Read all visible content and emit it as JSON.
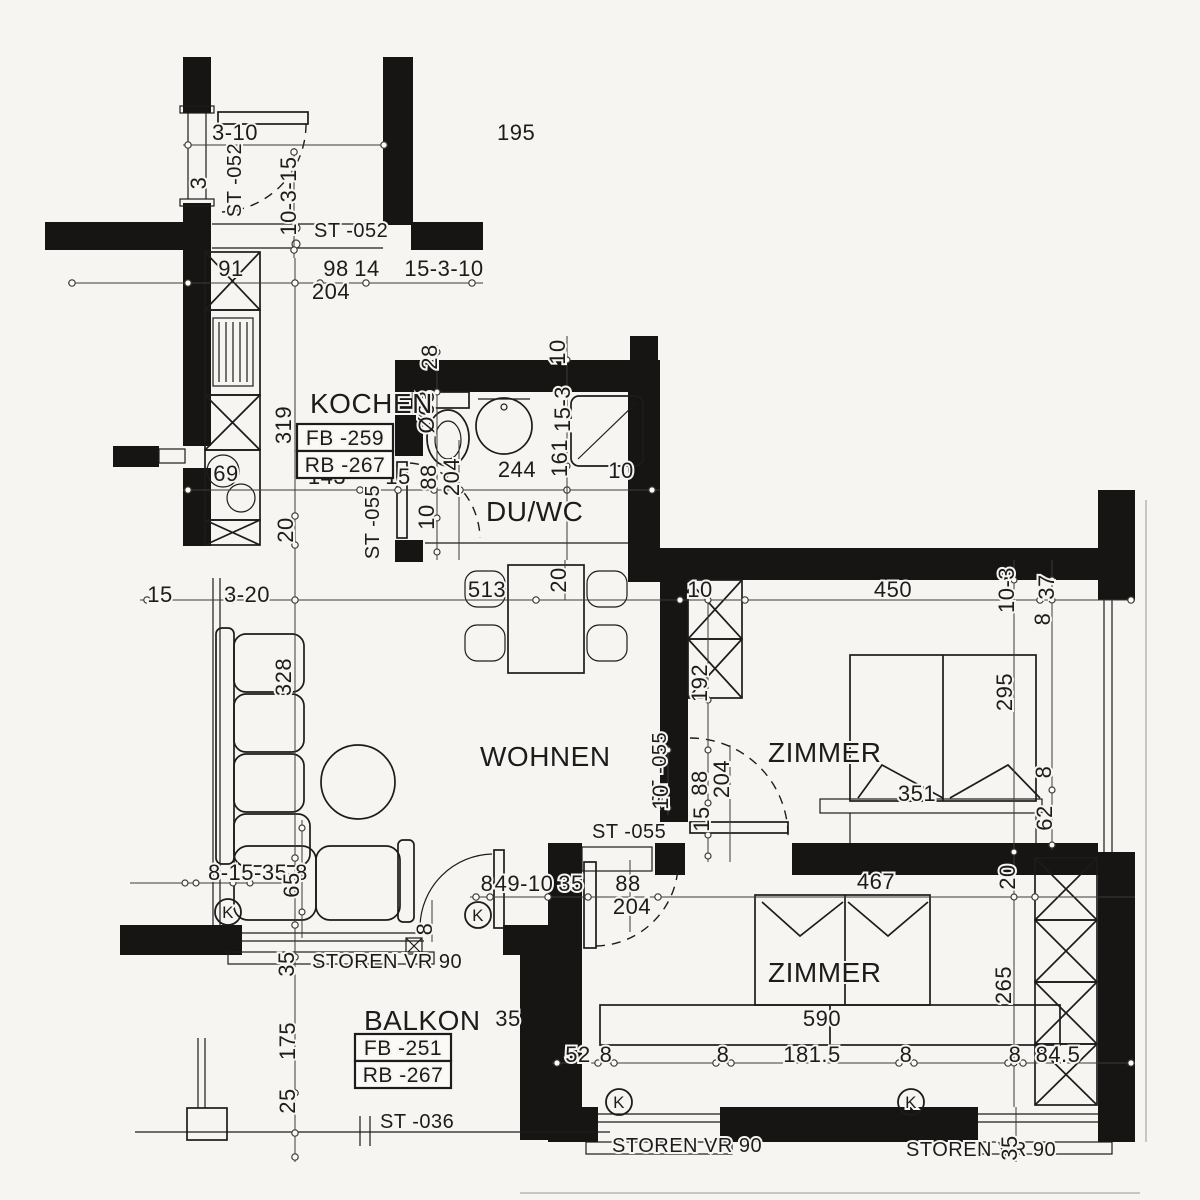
{
  "plan": {
    "title": "apartment-floor-plan",
    "colors": {
      "paper": "#f6f5f1",
      "ink": "#1c1c1c",
      "wall": "#171513",
      "dim": "#3d3b38"
    },
    "room_labels": [
      {
        "text": "KOCHEN",
        "x": 310,
        "y": 413
      },
      {
        "text": "DU/WC",
        "x": 486,
        "y": 521
      },
      {
        "text": "WOHNEN",
        "x": 480,
        "y": 766
      },
      {
        "text": "ZIMMER",
        "x": 768,
        "y": 762
      },
      {
        "text": "ZIMMER",
        "x": 768,
        "y": 982
      },
      {
        "text": "BALKON",
        "x": 364,
        "y": 1030
      }
    ],
    "boxed_labels": [
      {
        "text": "FB -259",
        "cx": 345,
        "cy": 438
      },
      {
        "text": "RB -267",
        "cx": 345,
        "cy": 465
      },
      {
        "text": "FB -251",
        "cx": 403,
        "cy": 1048
      },
      {
        "text": "RB -267",
        "cx": 403,
        "cy": 1075
      }
    ],
    "circled_labels": [
      {
        "text": "K",
        "cx": 228,
        "cy": 912
      },
      {
        "text": "K",
        "cx": 478,
        "cy": 915
      },
      {
        "text": "K",
        "cx": 619,
        "cy": 1102
      },
      {
        "text": "K",
        "cx": 911,
        "cy": 1102
      }
    ],
    "dimensions": [
      {
        "t": "3-10",
        "x": 212,
        "y": 140,
        "a": "s"
      },
      {
        "t": "195",
        "x": 497,
        "y": 140,
        "a": "s"
      },
      {
        "t": "3",
        "x": 206,
        "y": 183,
        "r": -90
      },
      {
        "t": "ST -052",
        "x": 241,
        "y": 180,
        "r": -90,
        "s": 20
      },
      {
        "t": "10-3-15",
        "x": 296,
        "y": 196,
        "r": -90
      },
      {
        "t": "ST -052",
        "x": 314,
        "y": 237,
        "a": "s",
        "s": 20
      },
      {
        "t": "91",
        "x": 231,
        "y": 276
      },
      {
        "t": "98",
        "x": 336,
        "y": 276
      },
      {
        "t": "14",
        "x": 367,
        "y": 276
      },
      {
        "t": "15-3-10",
        "x": 444,
        "y": 276
      },
      {
        "t": "204",
        "x": 331,
        "y": 299
      },
      {
        "t": "319",
        "x": 291,
        "y": 425,
        "r": -90
      },
      {
        "t": "28",
        "x": 437,
        "y": 357,
        "r": -90
      },
      {
        "t": "Ø63",
        "x": 434,
        "y": 412,
        "r": -90
      },
      {
        "t": "10",
        "x": 565,
        "y": 352,
        "r": -90
      },
      {
        "t": "15-3",
        "x": 570,
        "y": 409,
        "r": -90
      },
      {
        "t": "161",
        "x": 567,
        "y": 458,
        "r": -90
      },
      {
        "t": "69",
        "x": 226,
        "y": 481
      },
      {
        "t": "143",
        "x": 327,
        "y": 484
      },
      {
        "t": "15",
        "x": 398,
        "y": 484
      },
      {
        "t": "88",
        "x": 436,
        "y": 477,
        "r": -90
      },
      {
        "t": "204",
        "x": 459,
        "y": 477,
        "r": -90
      },
      {
        "t": "244",
        "x": 517,
        "y": 477
      },
      {
        "t": "10",
        "x": 621,
        "y": 478
      },
      {
        "t": "20",
        "x": 293,
        "y": 530,
        "r": -90
      },
      {
        "t": "ST -055",
        "x": 379,
        "y": 522,
        "r": -90,
        "s": 20
      },
      {
        "t": "10",
        "x": 434,
        "y": 517,
        "r": -90
      },
      {
        "t": "15",
        "x": 160,
        "y": 602
      },
      {
        "t": "3-20",
        "x": 224,
        "y": 602,
        "a": "s"
      },
      {
        "t": "513",
        "x": 487,
        "y": 597
      },
      {
        "t": "20",
        "x": 566,
        "y": 580,
        "r": -90
      },
      {
        "t": "10",
        "x": 700,
        "y": 597
      },
      {
        "t": "450",
        "x": 893,
        "y": 597
      },
      {
        "t": "10-3",
        "x": 1014,
        "y": 590,
        "r": -90
      },
      {
        "t": "37",
        "x": 1054,
        "y": 587,
        "r": -90
      },
      {
        "t": "8",
        "x": 1050,
        "y": 619,
        "r": -90
      },
      {
        "t": "328",
        "x": 291,
        "y": 677,
        "r": -90
      },
      {
        "t": "192",
        "x": 707,
        "y": 683,
        "r": -90
      },
      {
        "t": "ST -055",
        "x": 666,
        "y": 769,
        "r": -90,
        "s": 20
      },
      {
        "t": "10",
        "x": 668,
        "y": 797,
        "r": -90
      },
      {
        "t": "88",
        "x": 707,
        "y": 783,
        "r": -90
      },
      {
        "t": "204",
        "x": 729,
        "y": 779,
        "r": -90
      },
      {
        "t": "15",
        "x": 709,
        "y": 819,
        "r": -90
      },
      {
        "t": "295",
        "x": 1012,
        "y": 692,
        "r": -90
      },
      {
        "t": "8",
        "x": 1051,
        "y": 772,
        "r": -90
      },
      {
        "t": "351",
        "x": 917,
        "y": 801
      },
      {
        "t": "62",
        "x": 1052,
        "y": 818,
        "r": -90
      },
      {
        "t": "8-15-35-8",
        "x": 208,
        "y": 880,
        "a": "s"
      },
      {
        "t": "65",
        "x": 299,
        "y": 885,
        "r": -90
      },
      {
        "t": "8",
        "x": 432,
        "y": 929,
        "r": -90
      },
      {
        "t": "35",
        "x": 294,
        "y": 964,
        "r": -90
      },
      {
        "t": "STOREN VR 90",
        "x": 312,
        "y": 968,
        "a": "s",
        "s": 20
      },
      {
        "t": "8",
        "x": 487,
        "y": 891
      },
      {
        "t": "49-10",
        "x": 524,
        "y": 891
      },
      {
        "t": "35",
        "x": 571,
        "y": 891
      },
      {
        "t": "88",
        "x": 628,
        "y": 891
      },
      {
        "t": "204",
        "x": 632,
        "y": 914
      },
      {
        "t": "ST -055",
        "x": 592,
        "y": 838,
        "a": "s",
        "s": 20
      },
      {
        "t": "467",
        "x": 876,
        "y": 889
      },
      {
        "t": "20",
        "x": 1015,
        "y": 877,
        "r": -90
      },
      {
        "t": "265",
        "x": 1011,
        "y": 985,
        "r": -90
      },
      {
        "t": "590",
        "x": 822,
        "y": 1026
      },
      {
        "t": "52",
        "x": 578,
        "y": 1062
      },
      {
        "t": "8",
        "x": 606,
        "y": 1062
      },
      {
        "t": "8",
        "x": 723,
        "y": 1062
      },
      {
        "t": "181.5",
        "x": 812,
        "y": 1062
      },
      {
        "t": "8",
        "x": 906,
        "y": 1062
      },
      {
        "t": "8",
        "x": 1015,
        "y": 1062
      },
      {
        "t": "84.5",
        "x": 1058,
        "y": 1062
      },
      {
        "t": "175",
        "x": 295,
        "y": 1041,
        "r": -90
      },
      {
        "t": "25",
        "x": 295,
        "y": 1101,
        "r": -90
      },
      {
        "t": "35",
        "x": 508,
        "y": 1026
      },
      {
        "t": "ST -036",
        "x": 380,
        "y": 1128,
        "a": "s",
        "s": 20
      },
      {
        "t": "STOREN VR 90",
        "x": 612,
        "y": 1152,
        "a": "s",
        "s": 20
      },
      {
        "t": "STOREN VR 90",
        "x": 906,
        "y": 1156,
        "a": "s",
        "s": 20
      },
      {
        "t": "35",
        "x": 1017,
        "y": 1148,
        "r": -90
      }
    ]
  }
}
